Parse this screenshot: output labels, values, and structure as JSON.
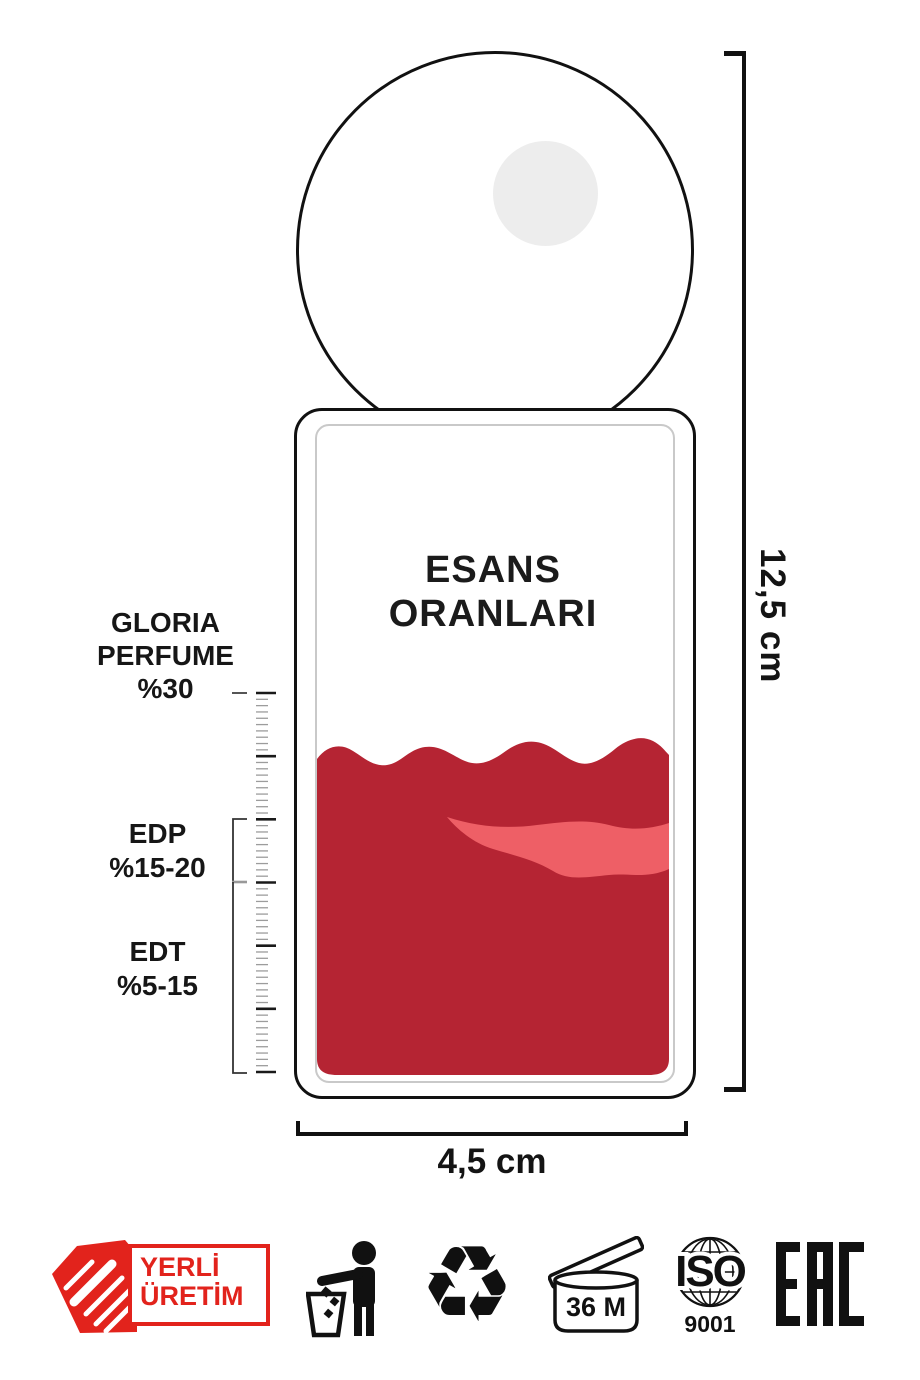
{
  "colors": {
    "accent_red": "#e2231c",
    "liquid_dark": "#b52433",
    "liquid_light": "#ee5f66",
    "ink": "#111111"
  },
  "bottle": {
    "title_line1": "ESANS",
    "title_line2": "ORANLARI"
  },
  "scale": {
    "groups": [
      {
        "lines": [
          "GLORIA",
          "PERFUME",
          "%30"
        ]
      },
      {
        "lines": [
          "EDP",
          "%15-20"
        ]
      },
      {
        "lines": [
          "EDT",
          "%5-15"
        ]
      }
    ],
    "ruler": {
      "major_ticks": 7,
      "minors_per_gap": 9
    }
  },
  "dimensions": {
    "height": "12,5 cm",
    "width": "4,5 cm"
  },
  "footer": {
    "yerli": {
      "line1": "YERLİ",
      "line2": "ÜRETİM"
    },
    "recycle_glyph": "♻",
    "pao_label": "36 M",
    "iso_label": "ISO",
    "iso_number": "9001",
    "eac_label": "EAC",
    "icon_names": [
      "yerli-uretim-badge",
      "tidyman-icon",
      "recycle-icon",
      "pao-36m-icon",
      "iso-9001-icon",
      "eac-mark"
    ]
  }
}
